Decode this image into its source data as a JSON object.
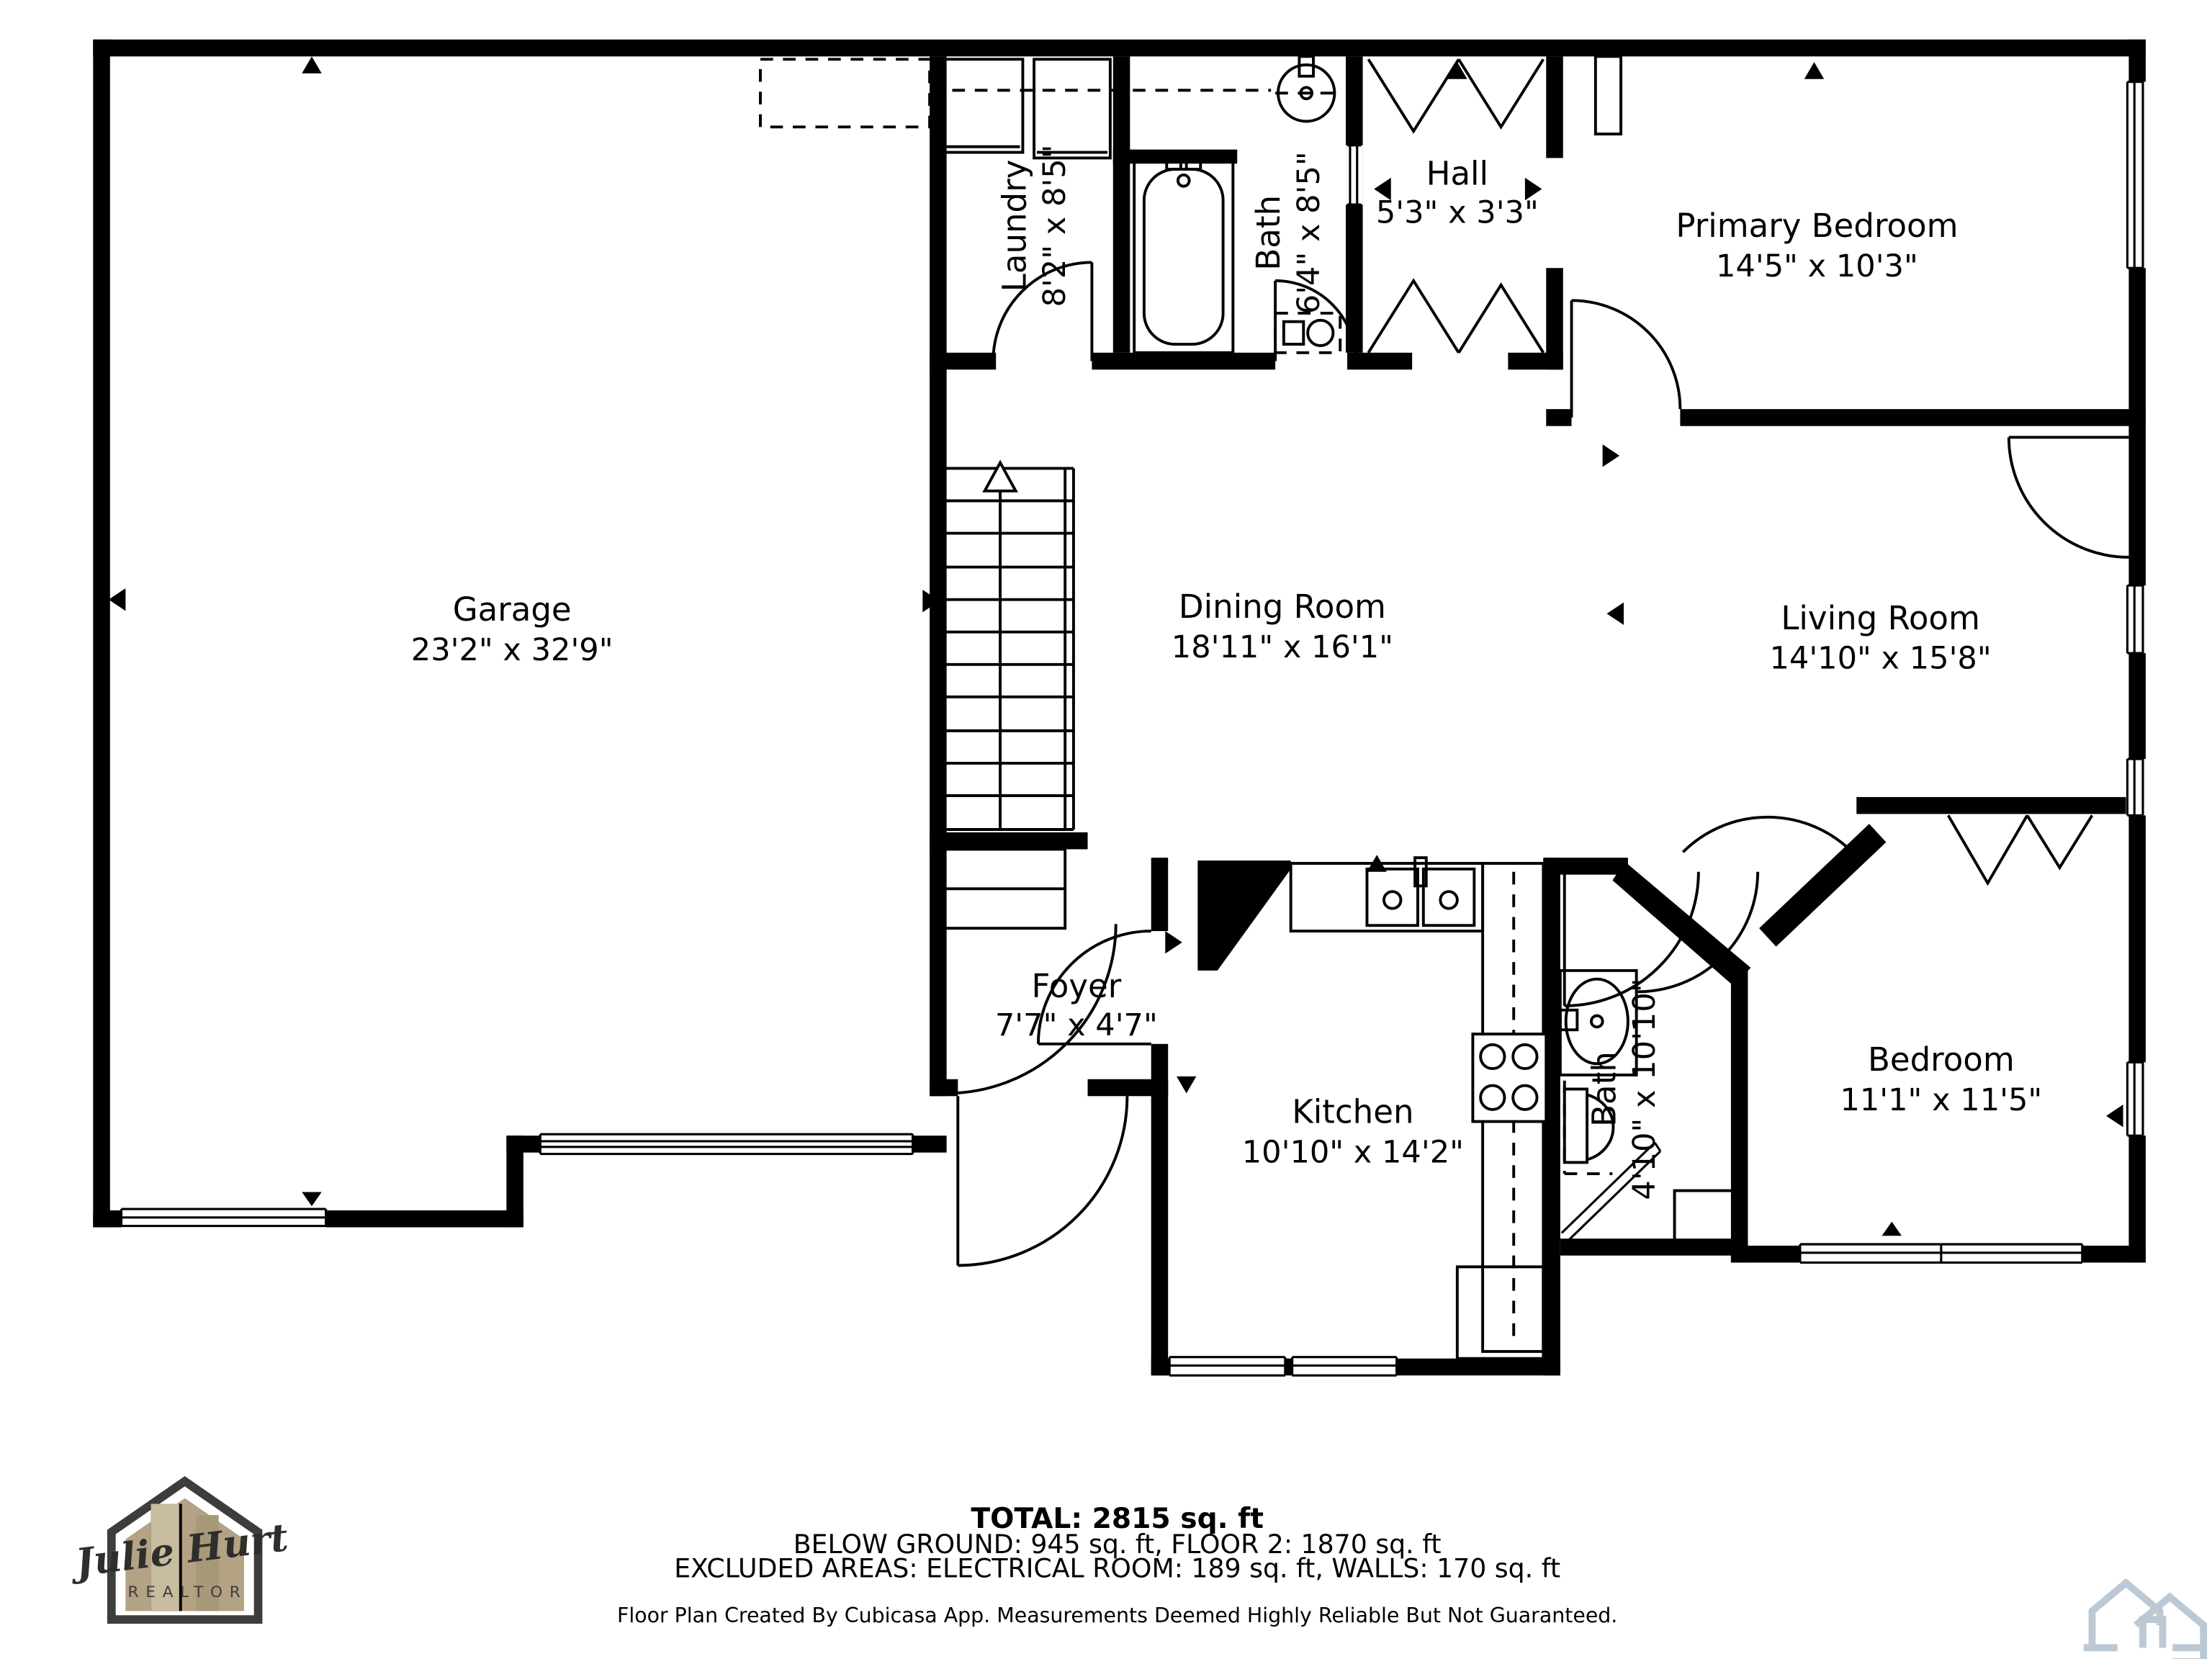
{
  "rooms": [
    {
      "name": "Garage",
      "dims": "23'2\" x 32'9\""
    },
    {
      "name": "Laundry",
      "dims": "8'2\" x 8'5\""
    },
    {
      "name": "Bath",
      "dims": "6'4\" x 8'5\""
    },
    {
      "name": "Hall",
      "dims": "5'3\" x 3'3\""
    },
    {
      "name": "Primary Bedroom",
      "dims": "14'5\" x 10'3\""
    },
    {
      "name": "Dining Room",
      "dims": "18'11\" x 16'1\""
    },
    {
      "name": "Living Room",
      "dims": "14'10\" x 15'8\""
    },
    {
      "name": "Foyer",
      "dims": "7'7\" x 4'7\""
    },
    {
      "name": "Kitchen",
      "dims": "10'10\" x 14'2\""
    },
    {
      "name": "Bath",
      "dims": "4'10\" x 10'10\""
    },
    {
      "name": "Bedroom",
      "dims": "11'1\" x 11'5\""
    }
  ],
  "footer": {
    "total": "TOTAL: 2815 sq. ft",
    "areas": "BELOW GROUND: 945 sq. ft, FLOOR 2: 1870 sq. ft",
    "excluded": "EXCLUDED AREAS: ELECTRICAL ROOM: 189 sq. ft, WALLS: 170 sq. ft",
    "disclaimer": "Floor Plan Created By Cubicasa App. Measurements Deemed Highly Reliable But Not Guaranteed."
  },
  "logo": {
    "name": "Julie Hurt",
    "subtitle": "REALTOR"
  },
  "icons": {
    "stairs_direction": "up-arrow",
    "watermark": "cubicasa-houses-icon"
  },
  "colors": {
    "walls": "#000000",
    "background": "#ffffff",
    "logo_outline": "#3d3d3b",
    "logo_fill": "#b3a283",
    "watermark": "#bcc9d4"
  }
}
